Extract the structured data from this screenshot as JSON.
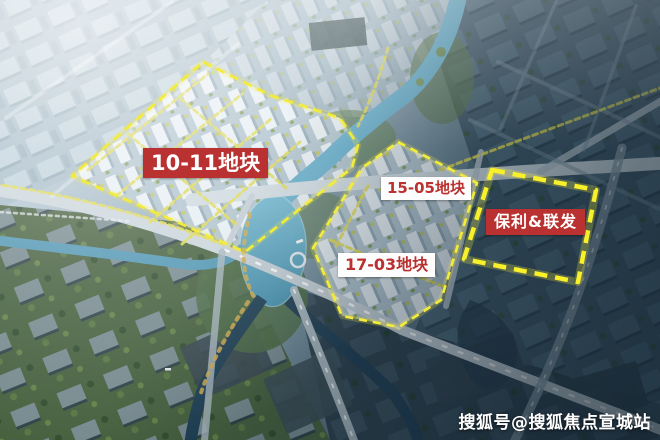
{
  "plots": [
    {
      "id": "10-11",
      "label": "10-11地块",
      "label_bg": "#b93130",
      "label_color": "#ffffff"
    },
    {
      "id": "15-05",
      "label": "15-05地块",
      "label_bg": "#ffffff",
      "label_color": "#b93130"
    },
    {
      "id": "17-03",
      "label": "17-03地块",
      "label_bg": "#ffffff",
      "label_color": "#b93130"
    },
    {
      "id": "baoli-lianfa",
      "label": "保利&联发",
      "label_bg": "#b93130",
      "label_color": "#ffffff"
    }
  ],
  "boundary": {
    "color": "#f4ec3a",
    "style": "dashed"
  },
  "watermark": {
    "text": "搜狐号@搜狐焦点宣城站",
    "color": "#ffffff"
  }
}
